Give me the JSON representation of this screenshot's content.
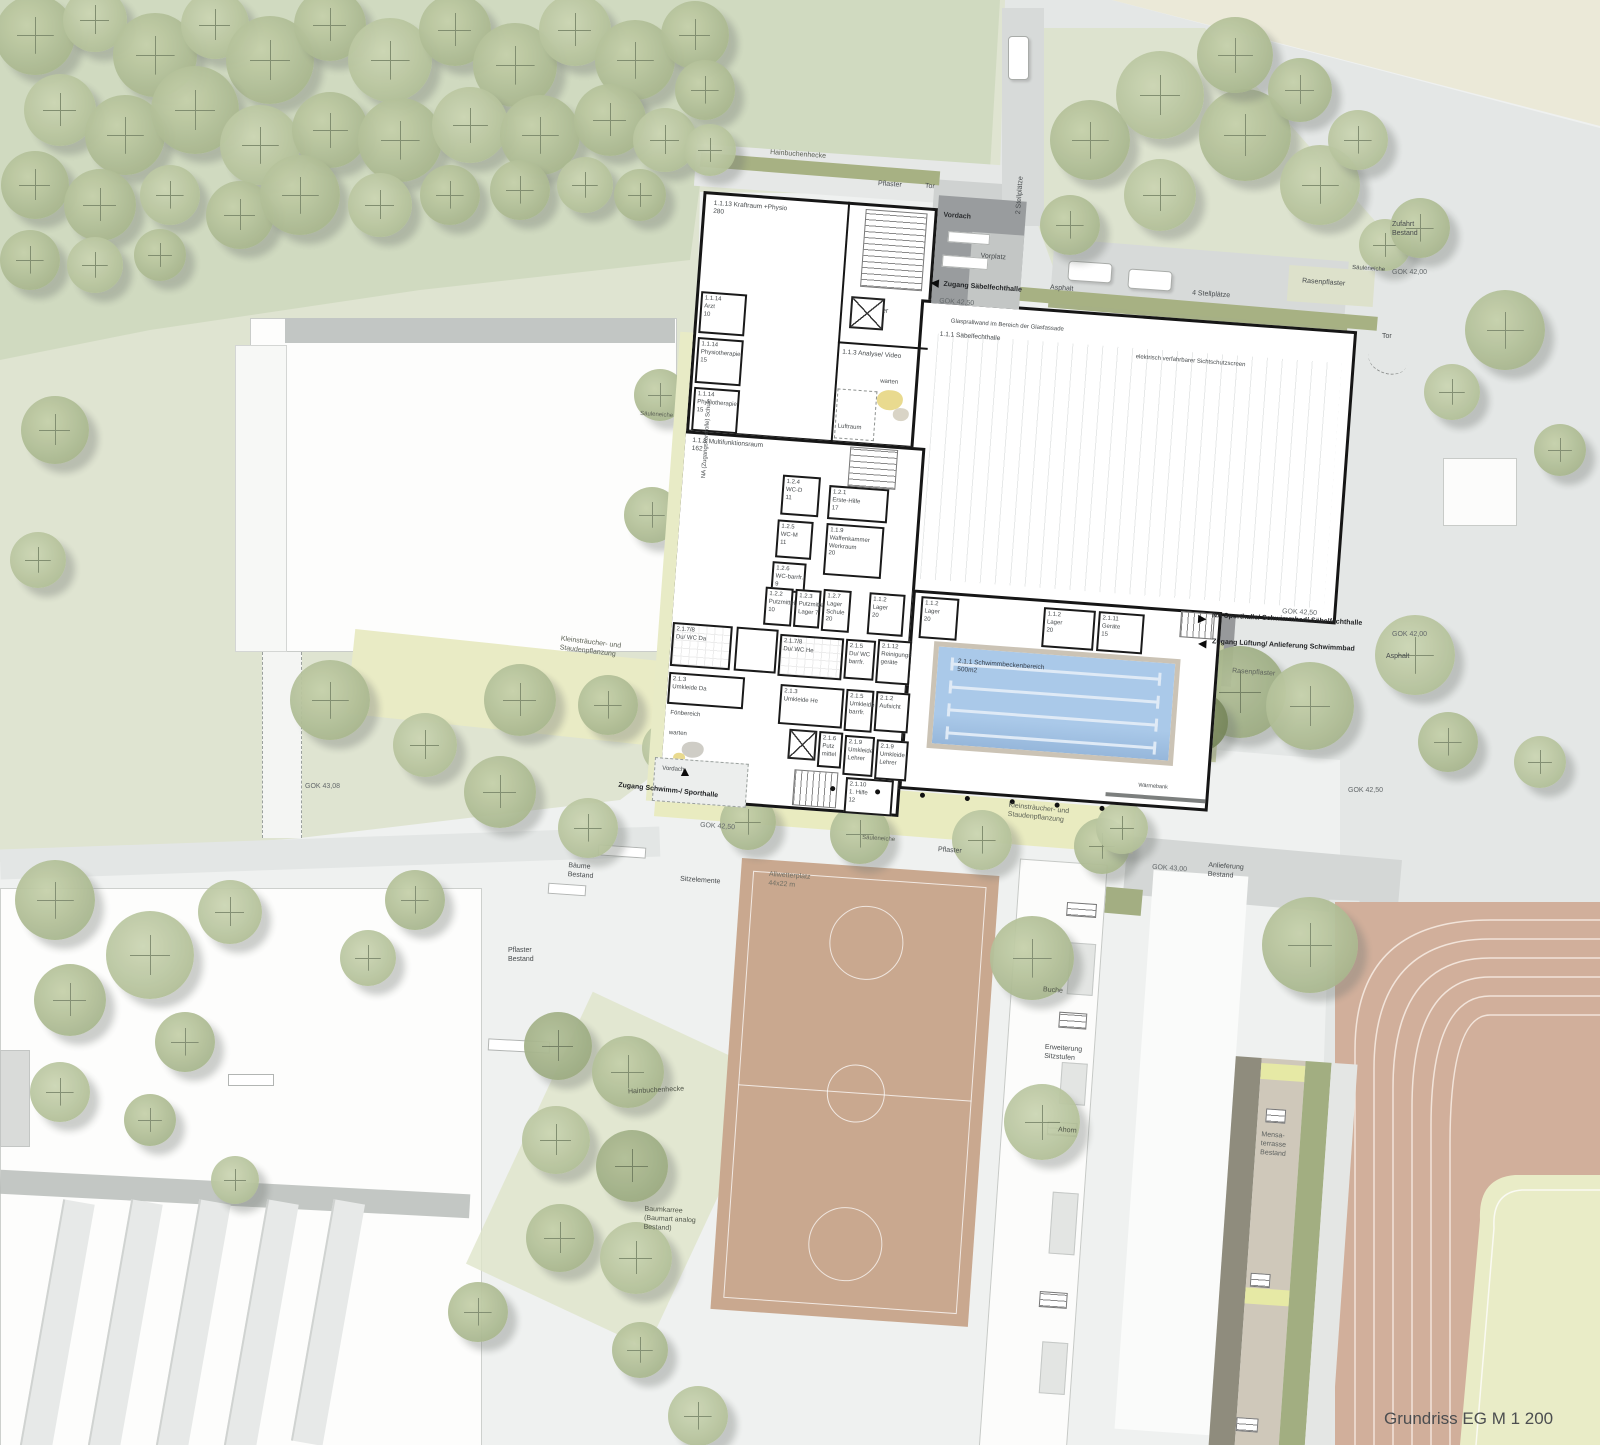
{
  "title": "Grundriss EG M 1 200",
  "site": {
    "hainbuchenhecke": "Hainbuchenhecke",
    "pflaster": "Pflaster",
    "tor": "Tor",
    "vordach": "Vordach",
    "vorplatz": "Vorplatz",
    "zugang_saebel": "Zugang Säbelfechthalle",
    "gok4250": "GOK 42,50",
    "gok4200": "GOK 42,00",
    "gok4308": "GOK 43,08",
    "gok4300": "GOK 43,00",
    "stellplaetze2": "2 Stellplätze",
    "stellplaetze4": "4 Stellplätze",
    "asphalt": "Asphalt",
    "rasenpflaster": "Rasenpflaster",
    "saeuleneiche": "Säuleneiche",
    "zufahrt_bestand": "Zufahrt\nBestand",
    "na_sport": "NA Sporthalle/ Schwimmbad/ Säbelfechthalle",
    "zugang_lueftung": "Zugang Lüftung/ Anlieferung Schwimmbad",
    "na_schule": "NA (Zugangskontrolle) Schule",
    "zugang_schwimm": "Zugang Schwimm-/ Sporthalle",
    "kleinstraeucher": "Kleinsträucher- und\nStaudenpflanzung",
    "sitzelemente": "Sitzelemente",
    "baeume_bestand": "Bäume\nBestand",
    "allwetterplatz": "Allwetterplatz\n44x22 m",
    "pflaster_bestand": "Pflaster\nBestand",
    "anlieferung_bestand": "Anlieferung\nBestand",
    "baumkarree": "Baumkarree\n(Baumart analog\nBestand)",
    "buche": "Buche",
    "ahorn": "Ahorn",
    "erweiterung": "Erweiterung\nSitzstufen",
    "mensa": "Mensa-\nterrasse\nBestand",
    "glasprallwand": "Glasprallwand im Bereich der Glasfassade",
    "screen": "elektrisch verfahrbarer Sichtschutzscreen",
    "waermebank": "Wärmebank"
  },
  "rooms": {
    "halle": "1.1.1 Säbelfechthalle",
    "kraftraum": "1.1.13 Kraftraum +Physio\n280",
    "arzt": "1.1.14\nArzt\n10",
    "physio": "1.1.14\nPhysiotherapie\n15",
    "foyer": "Foyer",
    "analyse": "1.1.3 Analyse/ Video",
    "warten": "warten",
    "luftraum": "Luftraum",
    "multifunktion": "1.1.8 Multifunktionsraum\n162",
    "wcd": "1.2.4\nWC-D\n11",
    "wcm": "1.2.5\nWC-M\n11",
    "wcbarr": "1.2.6\nWC-barrfr.\n9",
    "erstehilfe": "1.2.1\nErste-Hilfe\n17",
    "waffenkammer": "1.1.9\nWaffenkammer\nWerkraum\n20",
    "putzmittel10": "1.2.2\nPutzmittel\n10",
    "putzmittel_lager": "1.2.3\nPutzmittel\nLager 7",
    "lager_schule": "1.2.7\nLager\nSchule\n20",
    "lager": "1.1.2\nLager\n20",
    "geraete": "2.1.11\nGeräte\n15",
    "duwc_da": "2.1.7/8\nDu/ WC Da",
    "duwc_he": "2.1.7/8\nDu/ WC He",
    "duwc_barr": "2.1.5\nDu/ WC\nbarrfr.",
    "reinigung": "2.1.12\nReinigungs\ngeräte",
    "umkleide_da": "2.1.3\nUmkleide Da",
    "umkleide_he": "2.1.3\nUmkleide He",
    "umkleide_barr": "2.1.5\nUmkleide\nbarrfr.",
    "aufsicht": "2.1.2\nAufsicht",
    "foenbereich": "Fönbereich",
    "putzmittel6": "2.1.6\nPutz\nmittel",
    "umkleide_lehrer": "2.1.9\nUmkleide\nLehrer",
    "erste_hilfe_sw": "2.1.10\n1. Hilfe\n12",
    "pool": "2.1.1 Schwimmbeckenbereich\n500m2"
  }
}
